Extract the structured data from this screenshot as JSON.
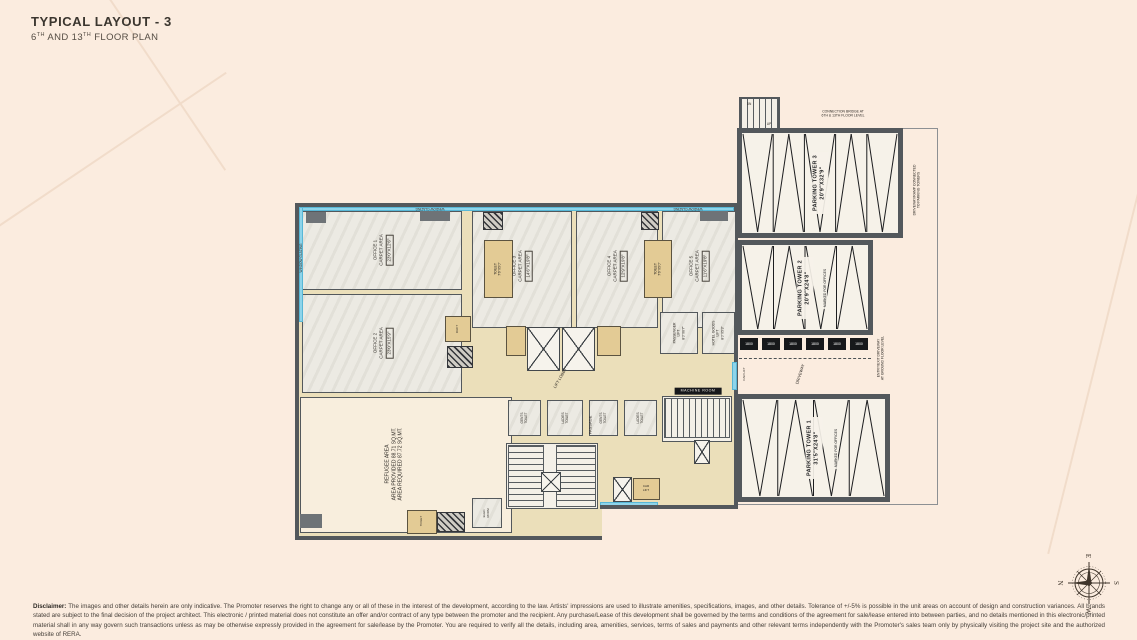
{
  "title": {
    "main": "TYPICAL LAYOUT - 3",
    "sub": {
      "p1": "6",
      "s1": "TH",
      "p2": " AND 13",
      "s2": "TH",
      "p3": " FLOOR PLAN"
    }
  },
  "compass": {
    "top": "E",
    "left": "N",
    "right": "S",
    "bottom": "W"
  },
  "disclaimer": {
    "label": "Disclaimer:",
    "text": "The images and other details herein are only indicative. The Promoter reserves the right to change any or all of these in the interest of the development, according to the law. Artists' impressions are used to illustrate amenities, specifications, images, and other details. Tolerance of +/-5% is possible in the unit areas on account of design and construction variances. All brands stated are subject to the final decision of the project architect. This electronic / printed material does not constitute an offer and/or contract of any type between the promoter and the recipient. Any purchase/Lease of this development shall be governed by the terms and conditions of the agreement for sale/lease entered into between parties, and no details mentioned in this electronic/printed material shall in any way govern such transactions unless as may be otherwise expressly provided in the agreement for sale/lease by the Promoter. You are required to verify all the details, including area, amenities, services, terms of sales and payments and other relevant terms independently with the Promoter's sales team only by physically visiting the project site and the authorized website of RERA."
  },
  "colors": {
    "wall": "#53585c",
    "glazing": "#8ed4ea",
    "toilet_tan": "#e3cb95",
    "corridor_beige": "#ebdfba",
    "background": "#fbecdf"
  },
  "plan": {
    "glazing_label": "WINDOW GLAZING",
    "pallet_label": "1800",
    "rooms": [
      {
        "name": "parking-wing-boundary",
        "cls": "outline-thin",
        "x": 737,
        "y": 128,
        "w": 201,
        "h": 377
      },
      {
        "name": "main-wing",
        "cls": "outline-thick",
        "x": 295,
        "y": 203,
        "w": 443,
        "h": 337
      },
      {
        "name": "office-1-room",
        "cls": "marble",
        "x": 302,
        "y": 211,
        "w": 160,
        "h": 79
      },
      {
        "name": "office-2-room",
        "cls": "marble",
        "x": 302,
        "y": 294,
        "w": 160,
        "h": 99
      },
      {
        "name": "office-3-room",
        "cls": "marble",
        "x": 472,
        "y": 211,
        "w": 100,
        "h": 117
      },
      {
        "name": "office-4-room",
        "cls": "marble",
        "x": 576,
        "y": 211,
        "w": 82,
        "h": 117
      },
      {
        "name": "office-5-room",
        "cls": "marble",
        "x": 662,
        "y": 211,
        "w": 74,
        "h": 117
      },
      {
        "name": "refuge-area-room",
        "cls": "cream",
        "x": 300,
        "y": 397,
        "w": 212,
        "h": 136
      },
      {
        "name": "wc-1-room",
        "cls": "marble",
        "x": 508,
        "y": 400,
        "w": 33,
        "h": 36
      },
      {
        "name": "wc-2-room",
        "cls": "marble",
        "x": 547,
        "y": 400,
        "w": 36,
        "h": 36
      },
      {
        "name": "wc-3-room",
        "cls": "marble",
        "x": 589,
        "y": 400,
        "w": 29,
        "h": 36
      },
      {
        "name": "wc-4-room",
        "cls": "marble",
        "x": 624,
        "y": 400,
        "w": 33,
        "h": 36
      },
      {
        "name": "passenger-lift-room",
        "cls": "marble",
        "x": 660,
        "y": 312,
        "w": 38,
        "h": 42
      },
      {
        "name": "goods-lift-room",
        "cls": "marble",
        "x": 702,
        "y": 312,
        "w": 33,
        "h": 42
      },
      {
        "name": "elec-room",
        "cls": "marble",
        "x": 472,
        "y": 498,
        "w": 30,
        "h": 30
      },
      {
        "name": "toilet-1-room",
        "cls": "tan",
        "x": 484,
        "y": 240,
        "w": 29,
        "h": 58
      },
      {
        "name": "toilet-2-room",
        "cls": "tan",
        "x": 644,
        "y": 240,
        "w": 28,
        "h": 58
      },
      {
        "name": "toilet-3-room",
        "cls": "tan",
        "x": 506,
        "y": 326,
        "w": 20,
        "h": 30
      },
      {
        "name": "toilet-4-room",
        "cls": "tan",
        "x": 597,
        "y": 326,
        "w": 24,
        "h": 30
      },
      {
        "name": "duct-room",
        "cls": "tan",
        "x": 445,
        "y": 316,
        "w": 26,
        "h": 26
      },
      {
        "name": "toilet-5-room",
        "cls": "tan",
        "x": 407,
        "y": 510,
        "w": 30,
        "h": 24
      },
      {
        "name": "car-lift-room",
        "cls": "tan",
        "x": 633,
        "y": 478,
        "w": 27,
        "h": 22
      },
      {
        "name": "staircase-1-base",
        "cls": "white",
        "x": 506,
        "y": 443,
        "w": 92,
        "h": 66
      },
      {
        "name": "staircase-2-base",
        "cls": "white",
        "x": 662,
        "y": 396,
        "w": 70,
        "h": 46
      },
      {
        "name": "staircase-1-flight-a",
        "cls": "treads-h",
        "x": 508,
        "y": 445,
        "w": 36,
        "h": 62
      },
      {
        "name": "staircase-1-flight-b",
        "cls": "treads-h",
        "x": 556,
        "y": 445,
        "w": 40,
        "h": 62
      },
      {
        "name": "staircase-2",
        "cls": "treads-v",
        "x": 664,
        "y": 398,
        "w": 66,
        "h": 40
      },
      {
        "name": "parking-staircase",
        "cls": "treads-v stairbox",
        "x": 739,
        "y": 97,
        "w": 41,
        "h": 34
      },
      {
        "name": "glazing-top",
        "cls": "glazing",
        "x": 299,
        "y": 207,
        "w": 435,
        "h": 4
      },
      {
        "name": "glazing-left",
        "cls": "glazing",
        "x": 299,
        "y": 207,
        "w": 4,
        "h": 115
      },
      {
        "name": "glazing-stair",
        "cls": "glazing",
        "x": 600,
        "y": 502,
        "w": 58,
        "h": 5
      },
      {
        "name": "glazing-carlift",
        "cls": "glazing",
        "x": 732,
        "y": 362,
        "w": 5,
        "h": 28
      },
      {
        "name": "lift-1-shaft",
        "cls": "xbox",
        "x": 527,
        "y": 327,
        "w": 33,
        "h": 44
      },
      {
        "name": "lift-2-shaft",
        "cls": "xbox",
        "x": 562,
        "y": 327,
        "w": 33,
        "h": 44
      },
      {
        "name": "car-lift-shaft",
        "cls": "xbox",
        "x": 613,
        "y": 477,
        "w": 19,
        "h": 25
      },
      {
        "name": "stair-1-lift-shaft",
        "cls": "xbox",
        "x": 541,
        "y": 472,
        "w": 20,
        "h": 20
      },
      {
        "name": "stair-2-lift-shaft",
        "cls": "xbox",
        "x": 694,
        "y": 440,
        "w": 16,
        "h": 24
      },
      {
        "name": "shaft-1",
        "cls": "hatch",
        "x": 447,
        "y": 346,
        "w": 26,
        "h": 22
      },
      {
        "name": "shaft-2",
        "cls": "hatch",
        "x": 483,
        "y": 212,
        "w": 20,
        "h": 18
      },
      {
        "name": "shaft-3",
        "cls": "hatch",
        "x": 641,
        "y": 212,
        "w": 18,
        "h": 18
      },
      {
        "name": "shaft-4",
        "cls": "hatch",
        "x": 437,
        "y": 512,
        "w": 28,
        "h": 20
      },
      {
        "name": "ledge-1",
        "cls": "ledge",
        "x": 306,
        "y": 212,
        "w": 20,
        "h": 11
      },
      {
        "name": "ledge-2",
        "cls": "ledge",
        "x": 420,
        "y": 211,
        "w": 30,
        "h": 10
      },
      {
        "name": "ledge-3",
        "cls": "ledge",
        "x": 700,
        "y": 211,
        "w": 28,
        "h": 10
      },
      {
        "name": "column-1",
        "cls": "ledge",
        "x": 300,
        "y": 514,
        "w": 22,
        "h": 14
      },
      {
        "name": "cutout-1",
        "cls": "cutout",
        "x": 602,
        "y": 509,
        "w": 140,
        "h": 34
      },
      {
        "name": "wall-seg-1",
        "cls": "wallseg",
        "x": 600,
        "y": 505,
        "w": 138,
        "h": 4
      },
      {
        "name": "driveway-dash",
        "cls": "dashline",
        "x": 739,
        "y": 358,
        "w": 132,
        "h": 1
      }
    ],
    "labels": [
      {
        "name": "office-1-label",
        "x": 383,
        "y": 250,
        "rot": -90,
        "fs": 4.5,
        "boxedLast": true,
        "lines": [
          "OFFICE 1",
          "CARPET AREA",
          "23'0\"X12'6\""
        ]
      },
      {
        "name": "office-2-label",
        "x": 383,
        "y": 343,
        "rot": -90,
        "fs": 4.5,
        "boxedLast": true,
        "lines": [
          "OFFICE 2",
          "CARPET AREA",
          "23'0\"X15'9\""
        ]
      },
      {
        "name": "office-3-label",
        "x": 522,
        "y": 266,
        "rot": -90,
        "fs": 4.5,
        "boxedLast": true,
        "lines": [
          "OFFICE 3",
          "CARPET AREA",
          "14'6\"X19'8\""
        ]
      },
      {
        "name": "office-4-label",
        "x": 617,
        "y": 266,
        "rot": -90,
        "fs": 4.5,
        "boxedLast": true,
        "lines": [
          "OFFICE 4",
          "CARPET AREA",
          "12'9\"X19'8\""
        ]
      },
      {
        "name": "office-5-label",
        "x": 699,
        "y": 266,
        "rot": -90,
        "fs": 4.5,
        "boxedLast": true,
        "lines": [
          "OFFICE 5",
          "CARPET AREA",
          "11'6\"X19'8\""
        ]
      },
      {
        "name": "refuge-area-label",
        "x": 394,
        "y": 464,
        "rot": -90,
        "fs": 5,
        "lines": [
          "REFUGEE AREA",
          "AREA PROVIDED 88.71 SQ.MT.",
          "AREA REQUIRED 87.72 SQ.MT."
        ]
      },
      {
        "name": "toilet-1-label",
        "x": 498,
        "y": 269,
        "rot": -90,
        "fs": 3.4,
        "lines": [
          "TOILET",
          "7'6\"X5'0\""
        ]
      },
      {
        "name": "toilet-2-label",
        "x": 658,
        "y": 269,
        "rot": -90,
        "fs": 3.4,
        "lines": [
          "TOILET",
          "7'6\"X5'0\""
        ]
      },
      {
        "name": "wc-1-label",
        "x": 524,
        "y": 418,
        "rot": -90,
        "fs": 3.2,
        "lines": [
          "GENTS",
          "TOILET"
        ]
      },
      {
        "name": "wc-2-label",
        "x": 565,
        "y": 418,
        "rot": -90,
        "fs": 3.2,
        "lines": [
          "LADIES",
          "TOILET"
        ]
      },
      {
        "name": "wc-3-label",
        "x": 603,
        "y": 418,
        "rot": -90,
        "fs": 3.2,
        "lines": [
          "GENTS",
          "TOILET"
        ]
      },
      {
        "name": "wc-4-label",
        "x": 640,
        "y": 418,
        "rot": -90,
        "fs": 3.2,
        "lines": [
          "LADIES",
          "TOILET"
        ]
      },
      {
        "name": "passenger-lift-label",
        "x": 679,
        "y": 333,
        "rot": -90,
        "fs": 3.4,
        "lines": [
          "PASSENGER",
          "LIFT",
          "8'0\"X6'7\""
        ]
      },
      {
        "name": "goods-lift-label",
        "x": 718,
        "y": 333,
        "rot": -90,
        "fs": 3.4,
        "lines": [
          "HOTEL GOODS",
          "LIFT",
          "8'0\"X5'3\""
        ]
      },
      {
        "name": "lift-lobby-label",
        "x": 560,
        "y": 378,
        "rot": -60,
        "fs": 4,
        "lines": [
          "LIFT LOBBY"
        ]
      },
      {
        "name": "passage-label",
        "x": 590,
        "y": 425,
        "rot": -90,
        "fs": 4,
        "lines": [
          "PASSAGE"
        ]
      },
      {
        "name": "window-glazing-top-1-label",
        "x": 430,
        "y": 209,
        "rot": 180,
        "fs": 3.2,
        "lines": [
          "WINDOW GLAZING"
        ]
      },
      {
        "name": "window-glazing-top-2-label",
        "x": 688,
        "y": 209,
        "rot": 180,
        "fs": 3.2,
        "lines": [
          "WINDOW GLAZING"
        ]
      },
      {
        "name": "window-glazing-left-label",
        "x": 301,
        "y": 258,
        "rot": -90,
        "fs": 3.2,
        "lines": [
          "WINDOW GLAZING"
        ]
      },
      {
        "name": "connection-note",
        "x": 843,
        "y": 114,
        "rot": 0,
        "fs": 3.4,
        "lines": [
          "CONNECTION BRIDGE AT",
          "6TH & 13TH FLOOR LEVEL"
        ]
      },
      {
        "name": "driveway-note-right",
        "x": 917,
        "y": 190,
        "rot": -90,
        "fs": 3.4,
        "lines": [
          "DRIVEWAY/RAMP CONNECTED",
          "TO PARKING TOWERS"
        ]
      },
      {
        "name": "entry-exit-note",
        "x": 881,
        "y": 358,
        "rot": -90,
        "fs": 3.4,
        "lines": [
          "ENTRY/EXIT DRIVEWAY",
          "AT GROUND FLOOR LEVEL"
        ]
      },
      {
        "name": "driveway-label",
        "x": 800,
        "y": 374,
        "rot": -72,
        "fs": 4,
        "lines": [
          "DRIVEWAY"
        ]
      },
      {
        "name": "car-lift-label",
        "x": 745,
        "y": 374,
        "rot": -90,
        "fs": 3,
        "lines": [
          "CAR LIFT"
        ]
      },
      {
        "name": "machine-room-label",
        "x": 698,
        "y": 391,
        "rot": 0,
        "fs": 3.6,
        "cls": "blackbar",
        "lines": [
          "MACHINE ROOM"
        ]
      },
      {
        "name": "stair-dn-label",
        "x": 749,
        "y": 104,
        "rot": 0,
        "fs": 3.2,
        "lines": [
          "DN"
        ]
      },
      {
        "name": "stair-up-label",
        "x": 769,
        "y": 124,
        "rot": 0,
        "fs": 3.2,
        "lines": [
          "UP"
        ]
      },
      {
        "name": "duct-label",
        "x": 458,
        "y": 329,
        "rot": -90,
        "fs": 3,
        "lines": [
          "DUCT"
        ]
      },
      {
        "name": "toilet-5-label",
        "x": 422,
        "y": 521,
        "rot": -90,
        "fs": 3,
        "lines": [
          "TOILET"
        ]
      },
      {
        "name": "car-lift-2-label",
        "x": 646,
        "y": 489,
        "rot": 0,
        "fs": 3,
        "lines": [
          "CAR",
          "LIFT"
        ]
      },
      {
        "name": "elec-room-label",
        "x": 487,
        "y": 513,
        "rot": -90,
        "fs": 3,
        "lines": [
          "ELEC.",
          "ROOM"
        ]
      }
    ],
    "towers": [
      {
        "name": "parking-tower-3",
        "x": 737,
        "y": 128,
        "w": 166,
        "h": 110,
        "bays": 5,
        "label": [
          "PARKING TOWER 3",
          "20'9\"X32'9\""
        ]
      },
      {
        "name": "parking-tower-2",
        "x": 737,
        "y": 240,
        "w": 136,
        "h": 95,
        "bays": 4,
        "label": [
          "PARKING TOWER 2",
          "20'9\"X24'8\""
        ],
        "extra": "MARKED FOR OFFICES"
      },
      {
        "name": "parking-tower-1",
        "x": 737,
        "y": 394,
        "w": 153,
        "h": 108,
        "bays": 4,
        "label": [
          "PARKING TOWER 1",
          "31'5\"X24'8\""
        ],
        "extra": "MARKED FOR OFFICES"
      }
    ],
    "pallets": {
      "y": 338,
      "h": 12,
      "w": 18,
      "xs": [
        740,
        762,
        784,
        806,
        828,
        850
      ]
    }
  }
}
